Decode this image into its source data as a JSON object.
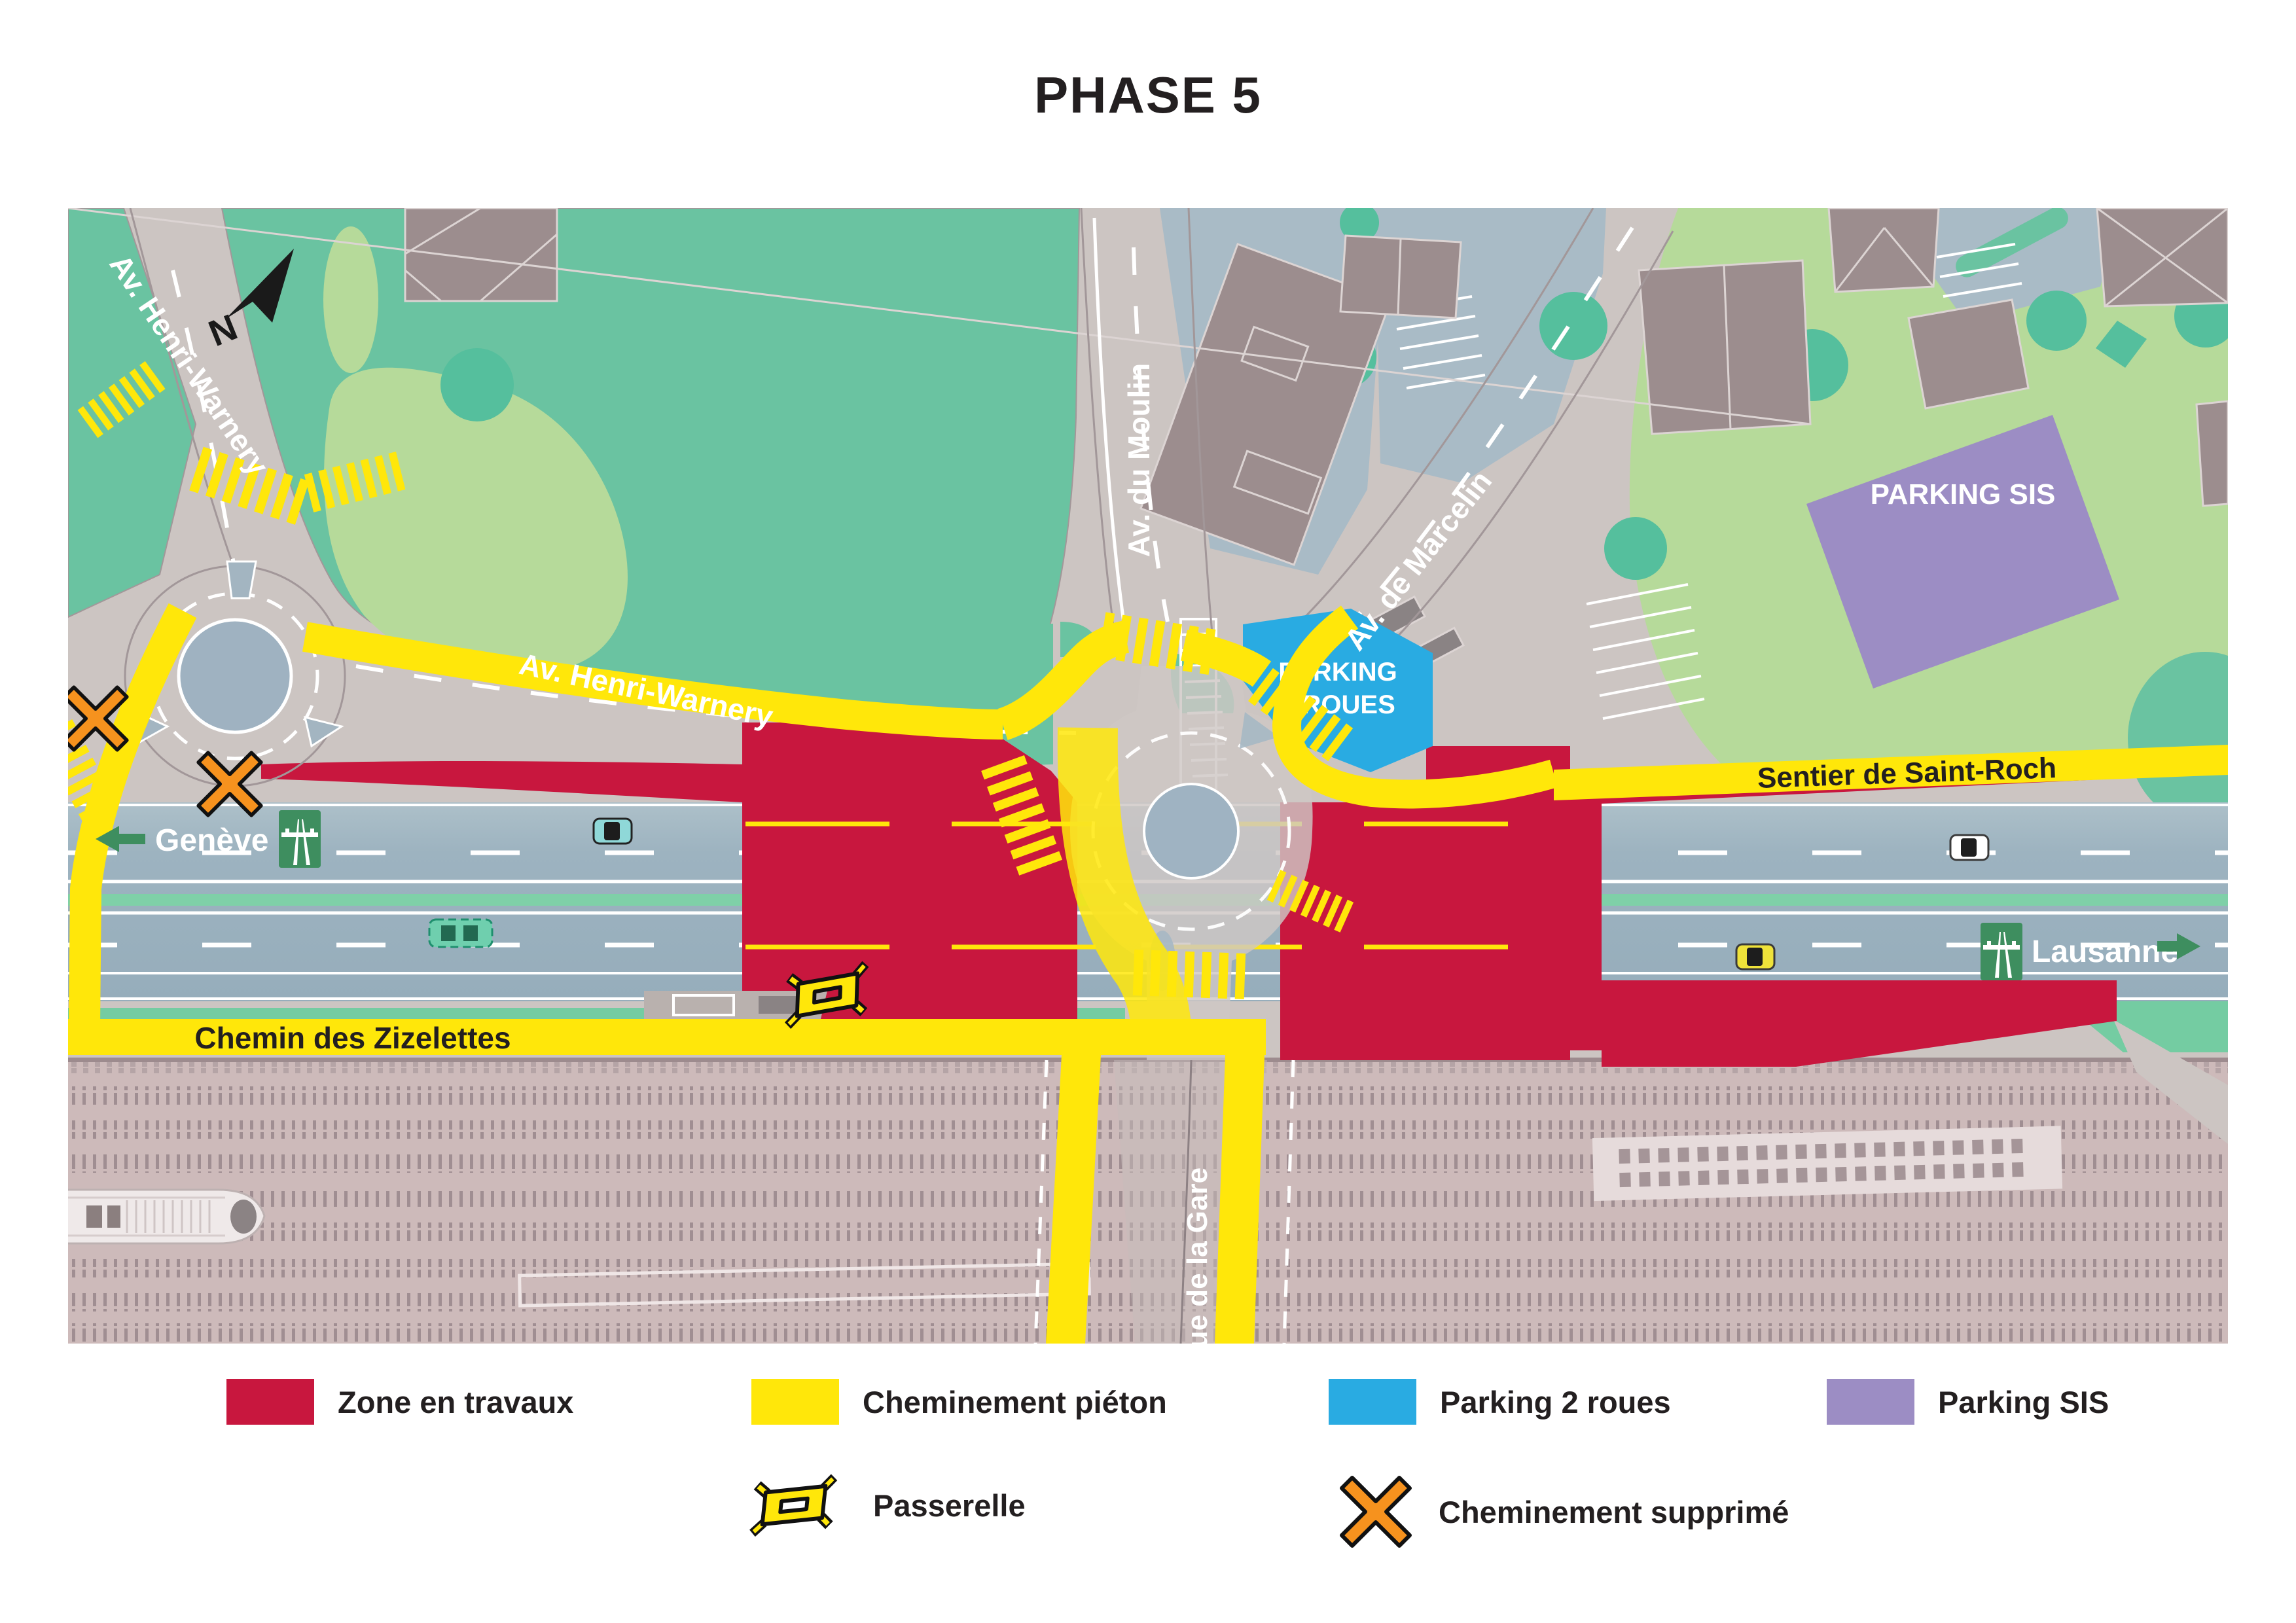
{
  "title": "PHASE 5",
  "map": {
    "north": "N",
    "street_labels": {
      "henri_warnery": "Av. Henri-Warnery",
      "henri_warnery_2": "Av. Henri-Warnery",
      "du_moulin": "Av. du Moulin",
      "de_marcelin": "Av. de Marcelin",
      "sentier_saint_roch": "Sentier de Saint-Roch",
      "zizelettes": "Chemin des Zizelettes",
      "rue_gare": "Rue de la Gare"
    },
    "zone_labels": {
      "parking_sis": "PARKING SIS",
      "parking_2roues_l1": "PARKING",
      "parking_2roues_l2": "2 ROUES"
    },
    "direction_signs": {
      "west": "Genève",
      "east": "Lausanne"
    }
  },
  "legend": {
    "zone_travaux": "Zone en travaux",
    "cheminement_pieton": "Cheminement piéton",
    "parking_2roues": "Parking 2 roues",
    "parking_sis": "Parking SIS",
    "passerelle": "Passerelle",
    "cheminement_supprime": "Cheminement supprimé"
  },
  "colors": {
    "zone_travaux": "#c8173e",
    "cheminement_pieton": "#ffe70a",
    "parking_2roues": "#29abe2",
    "parking_sis": "#9c8dc4",
    "cheminement_supprime": "#f6921e",
    "park_teal": "#6ac3a1",
    "park_light_green": "#b6da9a",
    "main_road": "#9db3c0",
    "road_gray": "#ccc5c2",
    "railway": "#cdbaba",
    "sign_green": "#3e8e5f"
  }
}
